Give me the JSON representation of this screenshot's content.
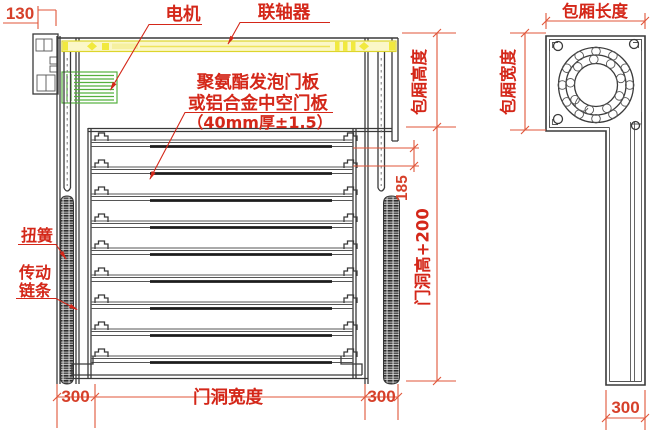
{
  "drawing": {
    "labels": {
      "motor": "电机",
      "coupling": "联轴器",
      "panel_line1": "聚氨酯发泡门板",
      "panel_line2": "或铝合金中空门板",
      "panel_line3": "（40mm厚±1.5）",
      "torsion_spring": "扭簧",
      "drive_chain_line1": "传动",
      "drive_chain_line2": "链条"
    },
    "dimensions": {
      "top_left_offset": "130",
      "box_height": "包厢高度",
      "gap": "185",
      "door_height": "门洞高+200",
      "left_margin": "300",
      "door_width": "门洞宽度",
      "right_margin": "300",
      "box_length": "包厢长度",
      "box_width": "包厢宽度",
      "rail_depth": "300"
    },
    "colors": {
      "annotation_red": "#d42719",
      "dimension_red": "#e0563a",
      "shaft_yellow": "#f1e93e",
      "motor_green": "#55b03e",
      "line_dark": "#3a3a3a"
    }
  }
}
